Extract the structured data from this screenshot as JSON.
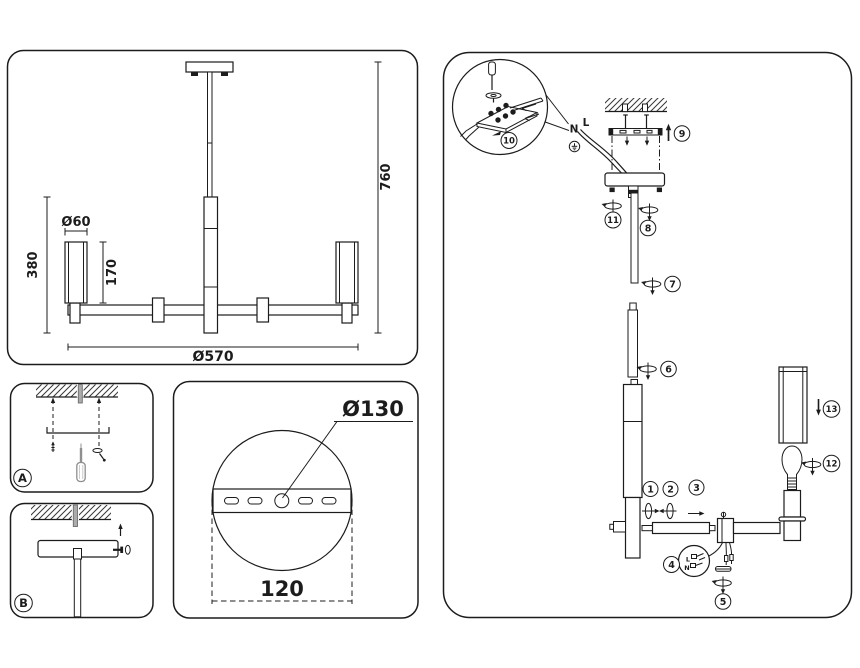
{
  "colors": {
    "line": "#1c1c1c",
    "gray": "#ababab",
    "background": "#ffffff"
  },
  "main_view": {
    "dim_overall_height": "760",
    "dim_body_height": "380",
    "dim_shade_diameter": "Ø60",
    "dim_shade_height": "170",
    "dim_overall_diameter": "Ø570"
  },
  "bracket_view": {
    "dim_bracket_diameter": "Ø130",
    "dim_mount_spacing": "120"
  },
  "details": {
    "a_label": "A",
    "b_label": "B"
  },
  "assembly": {
    "steps": [
      "1",
      "2",
      "3",
      "4",
      "5",
      "6",
      "7",
      "8",
      "9",
      "10",
      "11",
      "12",
      "13"
    ],
    "wire_neutral": "N",
    "wire_live": "L",
    "socket_wire_live": "L",
    "socket_wire_neutral": "N"
  }
}
